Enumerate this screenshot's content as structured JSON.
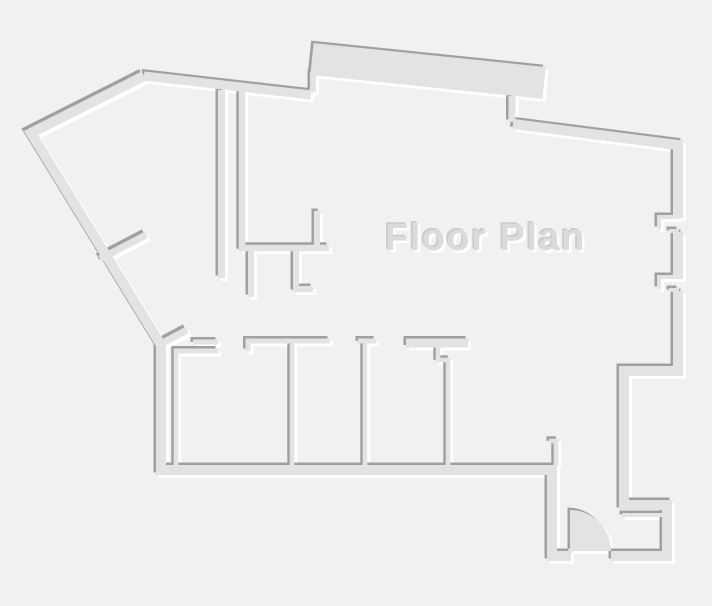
{
  "title": {
    "text": "Floor Plan",
    "x": 385,
    "y": 250,
    "font_size": 38,
    "letter_spacing": 1.5
  },
  "canvas": {
    "width": 712,
    "height": 606
  },
  "colors": {
    "background": "#f0f1f1",
    "wall_fill": "#e2e3e4",
    "wall_shadow": "#9fa1a1",
    "wall_highlight": "#ffffff",
    "title_fill": "#d9dbdc",
    "title_shadow": "#c7c9ca",
    "title_highlight": "#ffffff"
  },
  "floor_plan": {
    "walls": [
      {
        "name": "outer-west-south-wall",
        "d": "M144,76 L31,133 L161,345 L161,470 L552,470 L552,556 L571,556",
        "w": 10
      },
      {
        "name": "outer-southeast-wall",
        "d": "M611,556 L667,556 L667,505 L624,505 L624,371 L678,371 L678,291",
        "w": 10
      },
      {
        "name": "outer-east-wall-mid",
        "d": "M678,279 L678,232",
        "w": 10
      },
      {
        "name": "outer-east-north-wall",
        "d": "M678,218 L678,145 L513,124",
        "w": 10
      },
      {
        "name": "outer-top-wall",
        "d": "M144,76 L311,95",
        "w": 9
      },
      {
        "name": "top-bump-slab",
        "d": "M312,59 L544,83",
        "w": 32
      },
      {
        "name": "bump-inner-jog-wall",
        "d": "M512,96 L512,122",
        "w": 7
      },
      {
        "name": "bump-left-connector",
        "d": "M313,72 L313,92",
        "w": 6
      },
      {
        "name": "corridor-wall-left",
        "d": "M221.5,90 L221.5,278",
        "w": 7
      },
      {
        "name": "kitchen-u-wall",
        "d": "M242,90 L242,248 L329,248",
        "w": 6.5
      },
      {
        "name": "kitchen-return-wall",
        "d": "M317,248 L317,211",
        "w": 6
      },
      {
        "name": "kitchen-stub-left",
        "d": "M251,250 L251,297",
        "w": 6
      },
      {
        "name": "kitchen-stub-right-foot",
        "d": "M296,250 L296,289 L313,289",
        "w": 6
      },
      {
        "name": "diagonal-stub-upper",
        "d": "M100,259 L146,235",
        "w": 7
      },
      {
        "name": "diagonal-stub-lower",
        "d": "M159,345 L187,330",
        "w": 7
      },
      {
        "name": "room1-left-wall",
        "d": "M176,349 L176,466",
        "w": 4.5
      },
      {
        "name": "room1-top-wall",
        "d": "M174,351 L218,351",
        "w": 5
      },
      {
        "name": "room1-door-lintel",
        "d": "M193,342 L218,342",
        "w": 5
      },
      {
        "name": "rooms-top-wall-jog",
        "d": "M248,351 L248,341 L330,341",
        "w": 5
      },
      {
        "name": "room-divider-1",
        "d": "M292,343 L292,466",
        "w": 4.5
      },
      {
        "name": "room-divider-2-cap",
        "d": "M358,341 L376,341",
        "w": 5
      },
      {
        "name": "room-divider-2-stem",
        "d": "M365,342 L365,466",
        "w": 4.5
      },
      {
        "name": "room-divider-3-cap",
        "d": "M406,343 L468,343",
        "w": 9
      },
      {
        "name": "room-divider-3-stem",
        "d": "M438,346 L438,360 L448,360 L448,466",
        "w": 4.5
      },
      {
        "name": "room4-right-wall",
        "d": "M549,441 L556,441 L556,466",
        "w": 4.5
      },
      {
        "name": "entry-closet-wall",
        "d": "M622,515 L665,515",
        "w": 4
      },
      {
        "name": "east-opening-1-jamb",
        "d": "M679,217 L659,217 L659,229",
        "w": 4
      },
      {
        "name": "east-opening-1-tick",
        "d": "M679,231 L669,231",
        "w": 4
      },
      {
        "name": "east-opening-2-jamb",
        "d": "M679,277 L659,277 L659,289",
        "w": 4
      },
      {
        "name": "east-opening-2-tick",
        "d": "M679,290 L669,290",
        "w": 4
      }
    ],
    "door": {
      "name": "entry-door-leaf",
      "d": "M570,510 A41,41 0 0 1 611,551 L570,551 Z"
    }
  }
}
